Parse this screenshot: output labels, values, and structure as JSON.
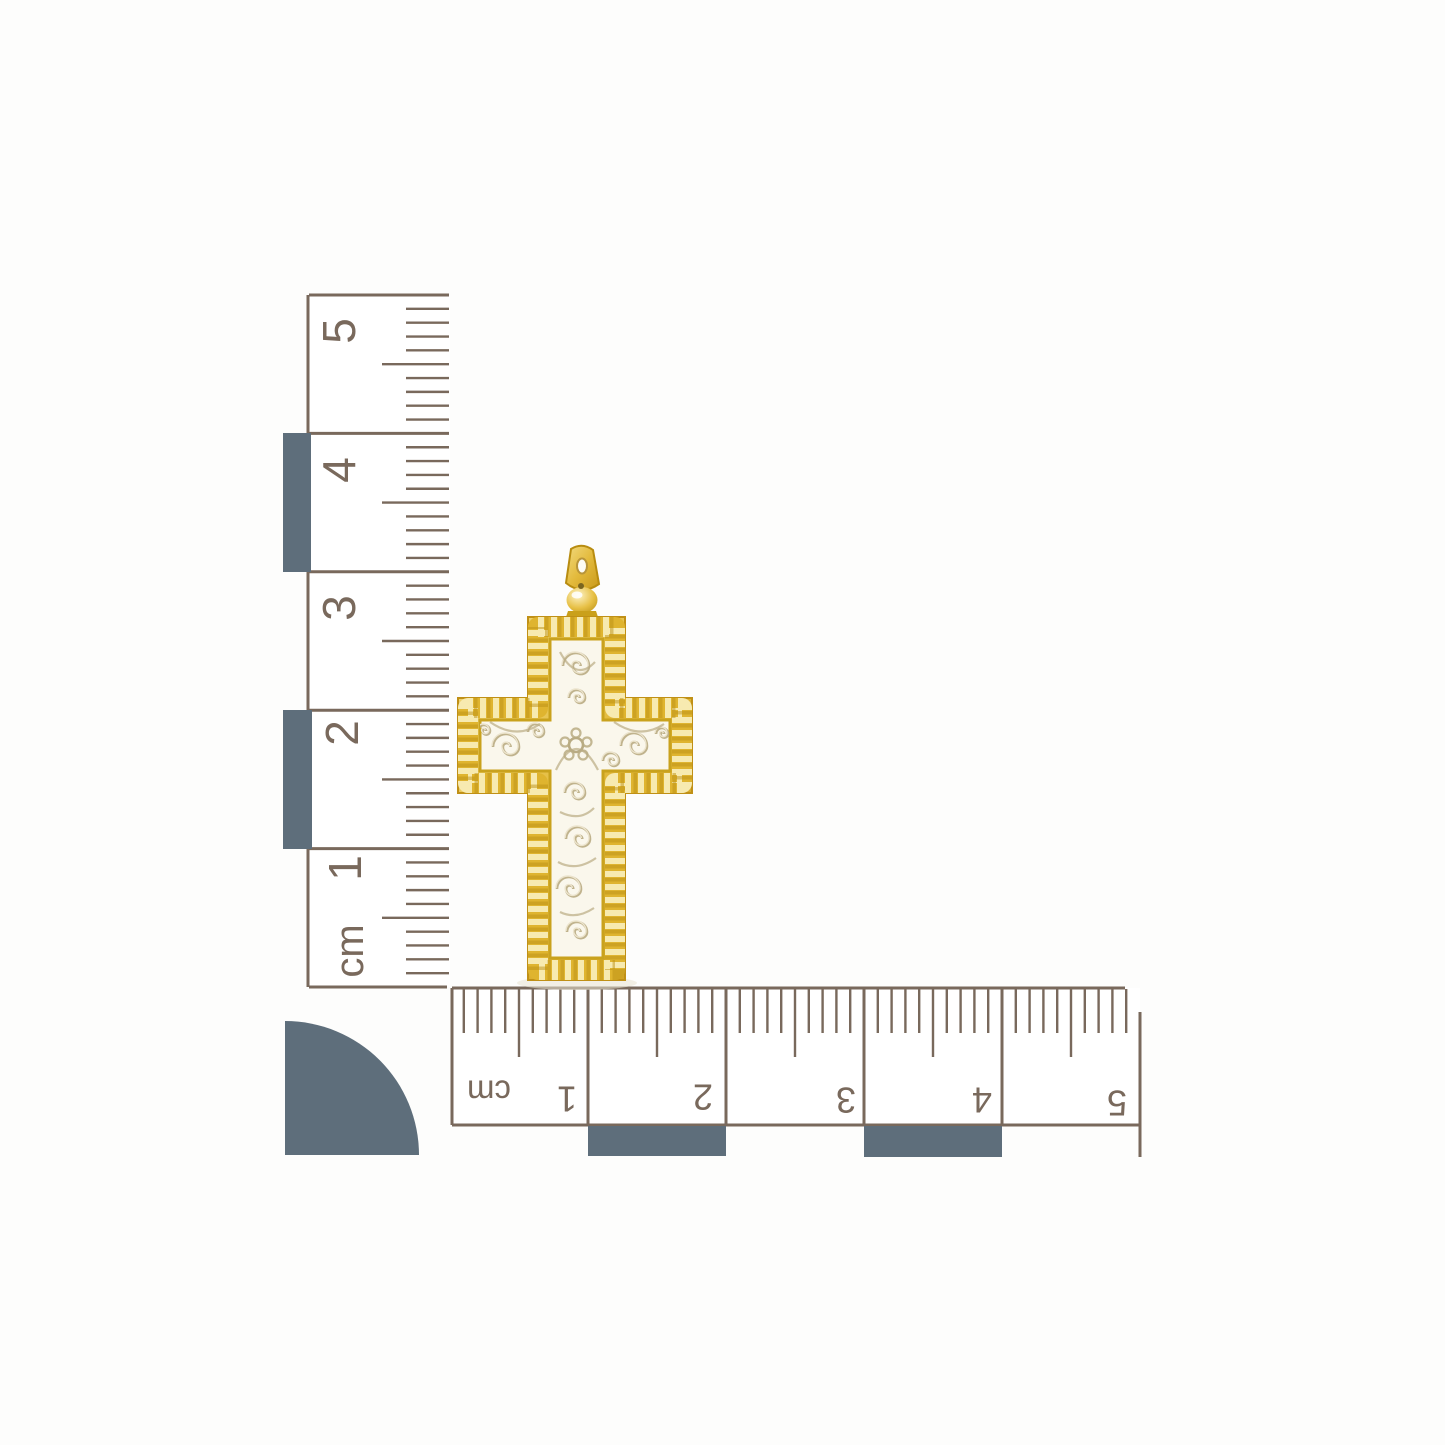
{
  "scene": {
    "background_color": "#fdfdfc",
    "subject": "Two-tone gold filigree cross pendant photographed beside centimeter scale rulers arranged in an L shape"
  },
  "rulers": {
    "ink_color": "#79695c",
    "block_color": "#5e6e7b",
    "vertical": {
      "unit_label": "cm",
      "tick_labels": [
        "5",
        "4",
        "3",
        "2",
        "1"
      ]
    },
    "horizontal": {
      "unit_label": "cm",
      "tick_labels": [
        "1",
        "2",
        "3",
        "4",
        "5"
      ]
    }
  },
  "pendant": {
    "name": "filigree cross pendant",
    "gold_color": "#ddb233",
    "gold_highlight": "#f6e8ad",
    "gold_shadow": "#bb8f15",
    "frame_color": "#c9a21d",
    "filigree_panel_color": "#faf7ec",
    "engraving_color": "#b9ab83"
  }
}
